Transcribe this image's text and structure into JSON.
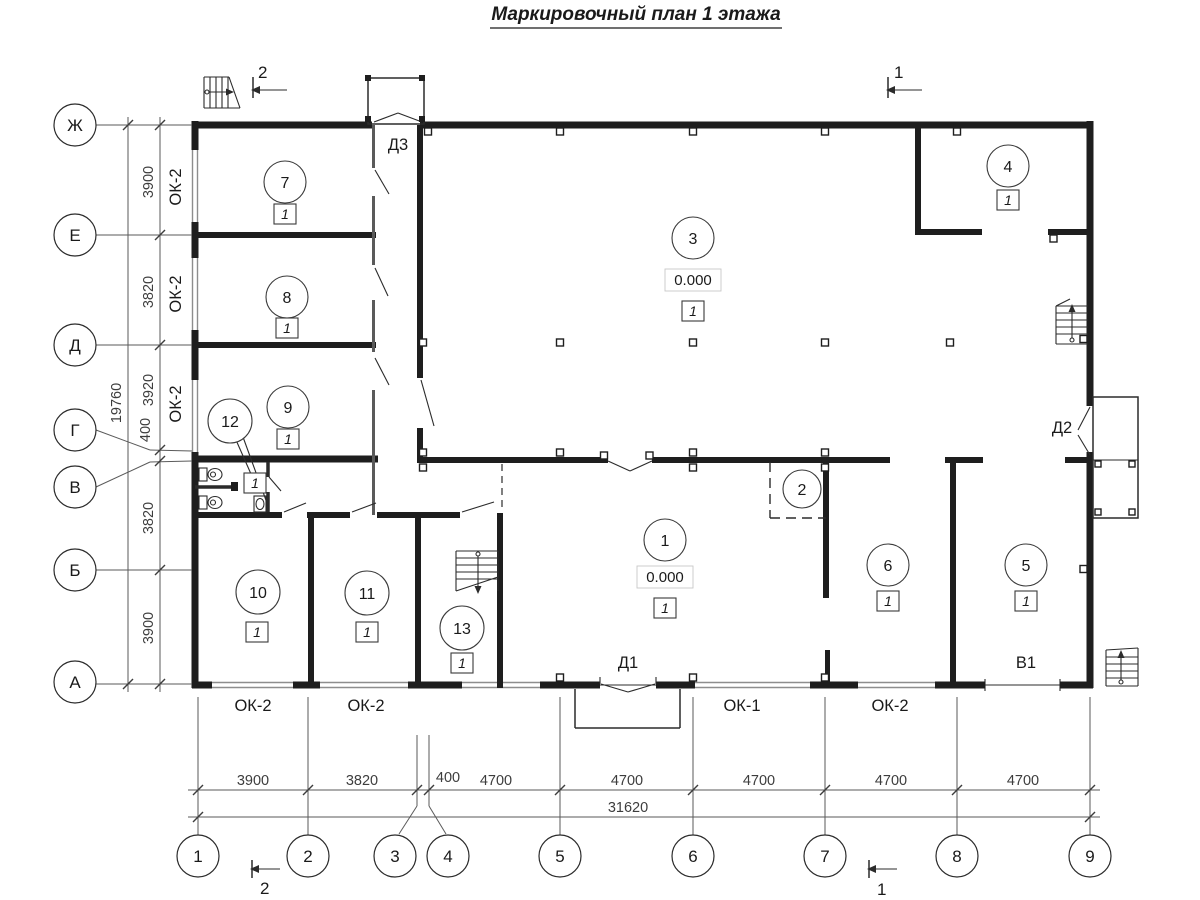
{
  "title": "Маркировочный план 1 этажа",
  "axes": {
    "rows": [
      {
        "label": "Ж"
      },
      {
        "label": "Е"
      },
      {
        "label": "Д"
      },
      {
        "label": "Г"
      },
      {
        "label": "В"
      },
      {
        "label": "Б"
      },
      {
        "label": "А"
      }
    ],
    "cols": [
      {
        "label": "1"
      },
      {
        "label": "2"
      },
      {
        "label": "3"
      },
      {
        "label": "4"
      },
      {
        "label": "5"
      },
      {
        "label": "6"
      },
      {
        "label": "7"
      },
      {
        "label": "8"
      },
      {
        "label": "9"
      }
    ]
  },
  "dims": {
    "left": [
      {
        "value": "3900"
      },
      {
        "value": "3820"
      },
      {
        "value": "3920"
      },
      {
        "value": "400"
      },
      {
        "value": "3820"
      },
      {
        "value": "3900"
      }
    ],
    "left_total": "19760",
    "bottom": [
      {
        "value": "3900"
      },
      {
        "value": "3820"
      },
      {
        "value": "400"
      },
      {
        "value": "4700"
      },
      {
        "value": "4700"
      },
      {
        "value": "4700"
      },
      {
        "value": "4700"
      },
      {
        "value": "4700"
      }
    ],
    "bottom_total": "31620"
  },
  "rooms": [
    {
      "number": "1",
      "floor_type": "1",
      "elevation": "0.000"
    },
    {
      "number": "2"
    },
    {
      "number": "3",
      "floor_type": "1",
      "elevation": "0.000"
    },
    {
      "number": "4",
      "floor_type": "1"
    },
    {
      "number": "5",
      "floor_type": "1"
    },
    {
      "number": "6",
      "floor_type": "1"
    },
    {
      "number": "7",
      "floor_type": "1"
    },
    {
      "number": "8",
      "floor_type": "1"
    },
    {
      "number": "9",
      "floor_type": "1"
    },
    {
      "number": "10",
      "floor_type": "1"
    },
    {
      "number": "11",
      "floor_type": "1"
    },
    {
      "number": "12",
      "floor_type": "1"
    },
    {
      "number": "13",
      "floor_type": "1"
    }
  ],
  "openings": {
    "windows": [
      {
        "label": "ОК-2"
      },
      {
        "label": "ОК-2"
      },
      {
        "label": "ОК-2"
      },
      {
        "label": "ОК-2"
      },
      {
        "label": "ОК-2"
      },
      {
        "label": "ОК-1"
      },
      {
        "label": "ОК-2"
      }
    ],
    "doors": [
      {
        "label": "Д3"
      },
      {
        "label": "Д1"
      },
      {
        "label": "Д2"
      },
      {
        "label": "В1"
      }
    ]
  },
  "sections": {
    "top_left": "2",
    "top_right": "1",
    "bottom_left": "2",
    "bottom_right": "1"
  }
}
